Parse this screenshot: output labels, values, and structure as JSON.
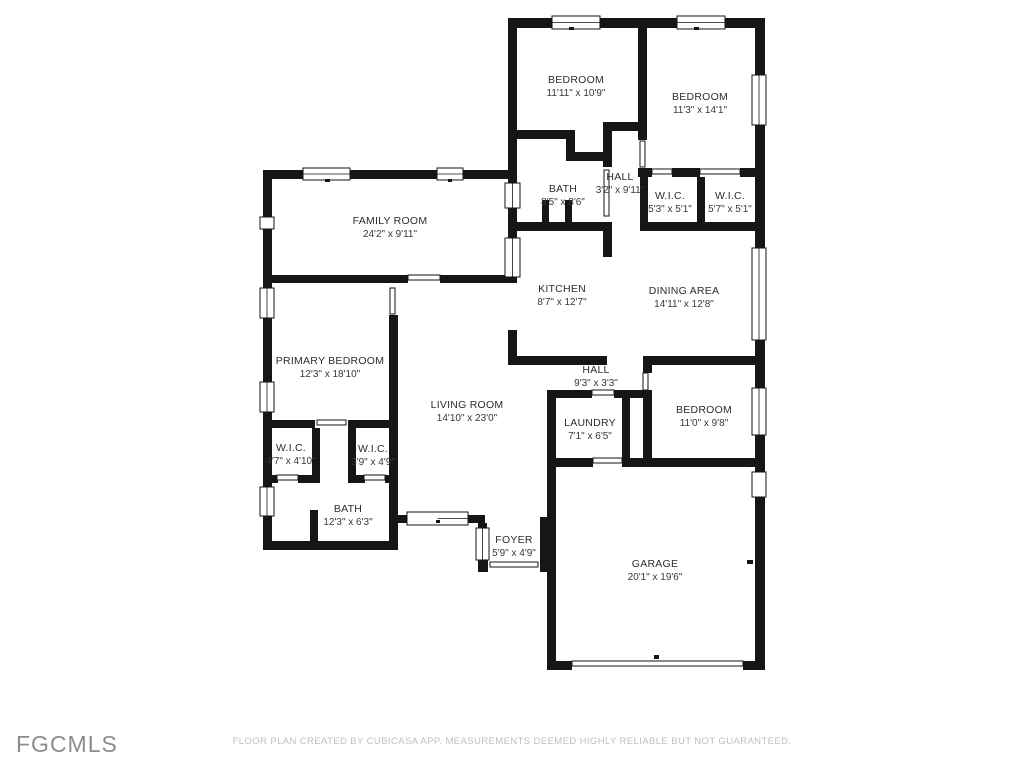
{
  "colors": {
    "wall": "#161616",
    "label_text": "#2d2d2d",
    "disclaimer_text": "#bfbfbf",
    "logo_text": "#8c8c8c"
  },
  "rooms": [
    {
      "id": "bedroom-1",
      "name": "BEDROOM",
      "dims": "11'11\" x 10'9\""
    },
    {
      "id": "bedroom-2",
      "name": "BEDROOM",
      "dims": "11'3\" x 14'1\""
    },
    {
      "id": "bath-1",
      "name": "BATH",
      "dims": "8'5\" x 8'6\""
    },
    {
      "id": "hall-1",
      "name": "HALL",
      "dims": "3'2\" x 9'11\""
    },
    {
      "id": "wic-1",
      "name": "W.I.C.",
      "dims": "5'3\" x 5'1\""
    },
    {
      "id": "wic-2",
      "name": "W.I.C.",
      "dims": "5'7\" x 5'1\""
    },
    {
      "id": "family-room",
      "name": "FAMILY ROOM",
      "dims": "24'2\" x 9'11\""
    },
    {
      "id": "kitchen",
      "name": "KITCHEN",
      "dims": "8'7\" x 12'7\""
    },
    {
      "id": "dining-area",
      "name": "DINING AREA",
      "dims": "14'11\" x 12'8\""
    },
    {
      "id": "primary-bedroom",
      "name": "PRIMARY BEDROOM",
      "dims": "12'3\" x 18'10\""
    },
    {
      "id": "living-room",
      "name": "LIVING ROOM",
      "dims": "14'10\" x 23'0\""
    },
    {
      "id": "hall-2",
      "name": "HALL",
      "dims": "9'3\" x 3'3\""
    },
    {
      "id": "laundry",
      "name": "LAUNDRY",
      "dims": "7'1\" x 6'5\""
    },
    {
      "id": "bedroom-3",
      "name": "BEDROOM",
      "dims": "11'0\" x 9'8\""
    },
    {
      "id": "wic-3",
      "name": "W.I.C.",
      "dims": "4'7\" x 4'10\""
    },
    {
      "id": "wic-4",
      "name": "W.I.C.",
      "dims": "3'9\" x 4'9\""
    },
    {
      "id": "bath-2",
      "name": "BATH",
      "dims": "12'3\" x 6'3\""
    },
    {
      "id": "foyer",
      "name": "FOYER",
      "dims": "5'9\" x 4'9\""
    },
    {
      "id": "garage",
      "name": "GARAGE",
      "dims": "20'1\" x 19'6\""
    }
  ],
  "footer": {
    "logo": "FGCMLS",
    "disclaimer": "FLOOR PLAN CREATED BY CUBICASA APP. MEASUREMENTS DEEMED HIGHLY RELIABLE BUT NOT GUARANTEED."
  }
}
